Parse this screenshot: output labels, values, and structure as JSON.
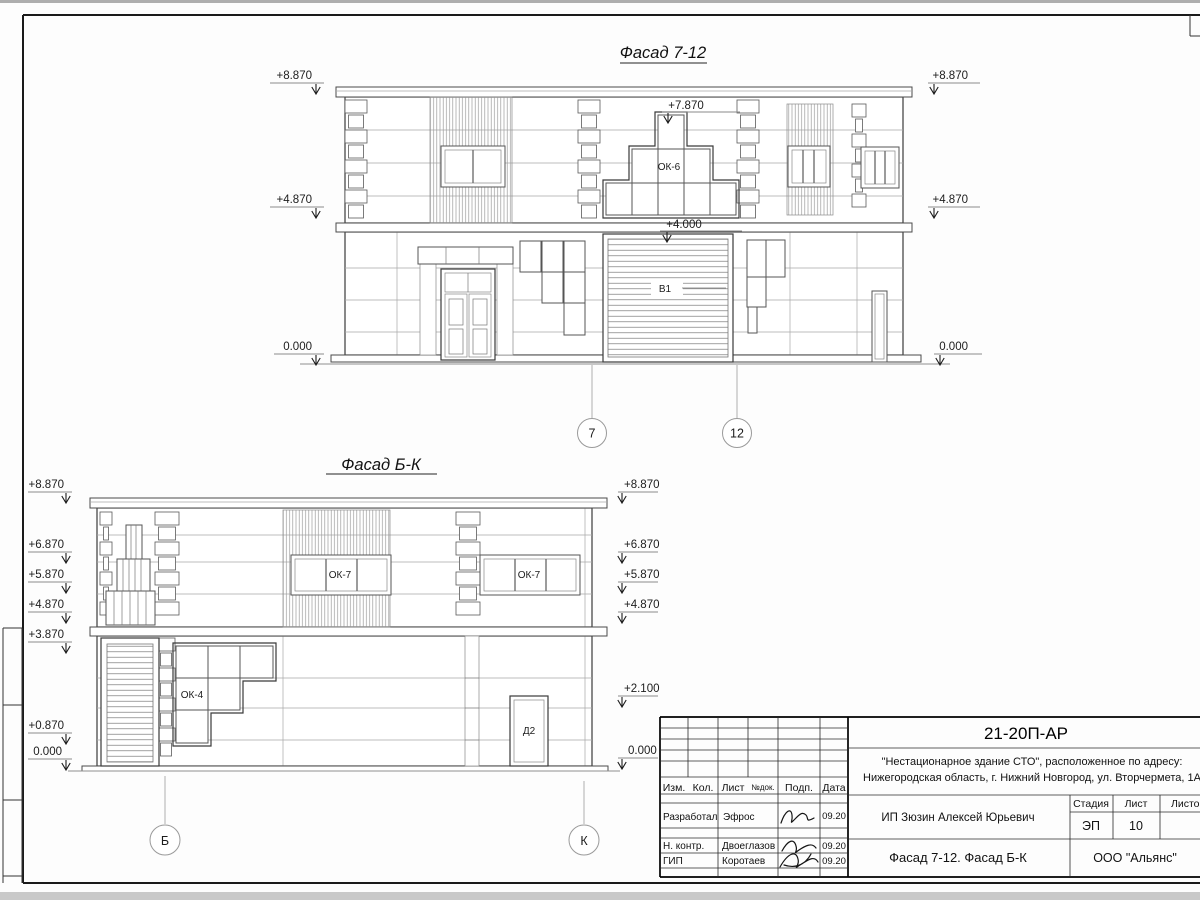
{
  "titles": {
    "top": "Фасад 7-12",
    "bottom": "Фасад Б-К"
  },
  "top_facade": {
    "marks": {
      "left": [
        "+8.870",
        "+4.870",
        "0.000"
      ],
      "right": [
        "+8.870",
        "+4.870",
        "0.000"
      ],
      "peak": "+7.870",
      "gate": "+4.000"
    },
    "labels": {
      "window_pyramid": "ОК-6",
      "gate": "В1"
    },
    "axes": {
      "left": "7",
      "right": "12"
    }
  },
  "bottom_facade": {
    "marks": {
      "left": [
        "+8.870",
        "+6.870",
        "+5.870",
        "+4.870",
        "+3.870",
        "+0.870",
        "0.000"
      ],
      "right": [
        "+8.870",
        "+6.870",
        "+5.870",
        "+4.870",
        "+2.100",
        "0.000"
      ]
    },
    "labels": {
      "window_left_upper": "ОК-7",
      "window_right_upper": "ОК-7",
      "window_ground": "ОК-4",
      "door": "Д2"
    },
    "axes": {
      "left": "Б",
      "right": "К"
    }
  },
  "titleblock": {
    "code": "21-20П-АР",
    "project_line1": "\"Нестационарное здание СТО\", расположенное по адресу:",
    "project_line2": "Нижегородская область, г. Нижний Новгород, ул. Вторчермета, 1А",
    "client": "ИП Зюзин Алексей Юрьевич",
    "sheet_title": "Фасад 7-12. Фасад Б-К",
    "organization": "ООО \"Альянс\"",
    "headers": {
      "izm": "Изм.",
      "kol": "Кол.",
      "list": "Лист",
      "doc": "№док.",
      "podp": "Подп.",
      "date": "Дата",
      "stage": "Стадия",
      "sheet": "Лист",
      "sheets": "Листов"
    },
    "stage_value": "ЭП",
    "sheet_value": "10",
    "rows": [
      {
        "role": "Разработал",
        "name": "Эфрос",
        "date": "09.20"
      },
      {
        "role": "Н. контр.",
        "name": "Двоеглазов",
        "date": "09.20"
      },
      {
        "role": "ГИП",
        "name": "Коротаев",
        "date": "09.20"
      }
    ]
  }
}
